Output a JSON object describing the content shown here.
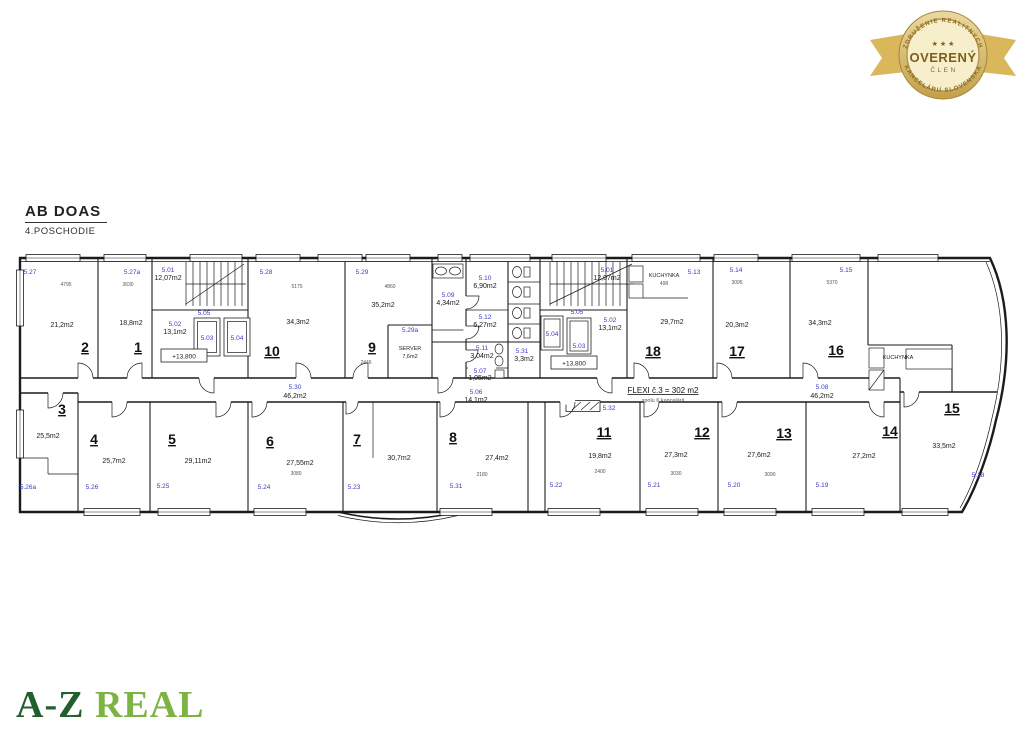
{
  "header": {
    "title": "AB DOAS",
    "subtitle": "4.POSCHODIE"
  },
  "badge": {
    "arc_top": "ZDRUŽENIE REALITNÝCH",
    "arc_bottom": "KANCELÁRIÍ SLOVENSKA",
    "stars": "★ ★ ★",
    "main": "OVERENÝ",
    "sub": "ČLEN",
    "gold": "#c9a84c"
  },
  "logo": {
    "part1": "A-Z",
    "part2": "REAL",
    "color1": "#235e2f",
    "color2": "#7db343"
  },
  "plan": {
    "flexi_title": "FLEXI č.3 = 302 m2",
    "flexi_sub": "spolu 6 kancelárií",
    "level_left": "+13,800",
    "level_right": "+13,800",
    "kuchynka_18": "KUCHYNKA",
    "kuchynka_right": "KUCHYNKA",
    "server_name": "SERVER",
    "server_area": "7,6m2"
  },
  "offices": {
    "o1": {
      "num": "1",
      "area": "18,8m2",
      "code": "5.27a"
    },
    "o2": {
      "num": "2",
      "area": "21,2m2",
      "code": "5.27"
    },
    "o3": {
      "num": "3",
      "area": "25,5m2",
      "code": "5.26a"
    },
    "o4": {
      "num": "4",
      "area": "25,7m2",
      "code": "5.26"
    },
    "o5": {
      "num": "5",
      "area": "29,11m2",
      "code": "5.25"
    },
    "o6": {
      "num": "6",
      "area": "27,55m2",
      "code": "5.24"
    },
    "o7": {
      "num": "7",
      "area": "30,7m2",
      "code": "5.23"
    },
    "o8": {
      "num": "8",
      "area": "27,4m2",
      "code": "5.31"
    },
    "o9": {
      "num": "9",
      "area": "35,2m2",
      "code": "5.29"
    },
    "o10": {
      "num": "10",
      "area": "34,3m2",
      "code": "5.28"
    },
    "o11": {
      "num": "11",
      "area": "19,8m2",
      "code": "5.22"
    },
    "o12": {
      "num": "12",
      "area": "27,3m2",
      "code": "5.21"
    },
    "o13": {
      "num": "13",
      "area": "27,6m2",
      "code": "5.20"
    },
    "o14": {
      "num": "14",
      "area": "27,2m2",
      "code": "5.19"
    },
    "o15": {
      "num": "15",
      "area": "33,5m2",
      "code": "5.18"
    },
    "o16": {
      "num": "16",
      "area": "34,3m2",
      "code": "5.15"
    },
    "o17": {
      "num": "17",
      "area": "20,3m2",
      "code": "5.14"
    },
    "o18": {
      "num": "18",
      "area": "29,7m2",
      "code": "5.13"
    }
  },
  "service": {
    "stair_left_code": "5.01",
    "stair_left_area": "12,07m2",
    "stair_right_code": "5.01",
    "stair_right_area": "12,07m2",
    "hall_left": "5.05",
    "hall_right": "5.05",
    "lobby_left_code": "5.02",
    "lobby_left_area": "13,1m2",
    "lobby_right_code": "5.02",
    "lobby_right_area": "13,1m2",
    "lift_left_a": "5.03",
    "lift_left_b": "5.04",
    "lift_right_a": "5.04",
    "lift_right_b": "5.03",
    "corridor_left_code": "5.30",
    "corridor_left_area": "46,2m2",
    "corridor_mid_code": "5.06",
    "corridor_mid_area": "14,1m2",
    "corridor_right_code": "5.08",
    "corridor_right_area": "46,2m2",
    "wc_lobby_code": "5.09",
    "wc_lobby_area": "4,34m2",
    "wc1_code": "5.10",
    "wc1_area": "6,90m2",
    "wc2_code": "5.12",
    "wc2_area": "6,27m2",
    "wc3_code": "5.11",
    "wc3_area": "3,04m2",
    "store_code": "5.07",
    "store_area": "1,05m2",
    "wc4_code": "5.31",
    "wc4_area": "3,3m2",
    "niche_code": "5.32",
    "server_code": "5.29a"
  },
  "dims": {
    "r1": "3630",
    "r2": "4795",
    "r9": "4860",
    "r9b": "2446",
    "r10": "5175",
    "r16": "5370",
    "r17": "3095",
    "k18": "498",
    "r6": "3080",
    "r8": "2180",
    "r11": "2400",
    "r12": "3030",
    "r13": "3090"
  }
}
